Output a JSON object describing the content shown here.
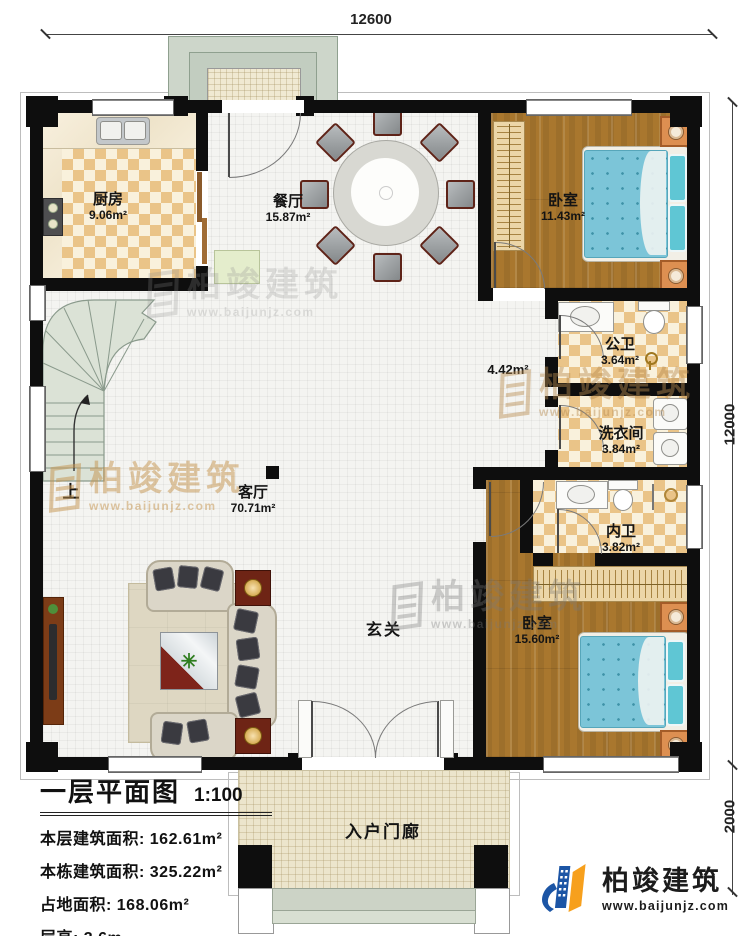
{
  "plan": {
    "dimensions": {
      "top_width": "12600",
      "right_height": "12000",
      "right_porch": "2000"
    },
    "rooms": {
      "kitchen": {
        "name": "厨房",
        "area": "9.06m²"
      },
      "dining": {
        "name": "餐厅",
        "area": "15.87m²"
      },
      "bedroom_top": {
        "name": "卧室",
        "area": "11.43m²"
      },
      "public_bath": {
        "name": "公卫",
        "area": "3.64m²"
      },
      "laundry": {
        "name": "洗衣间",
        "area": "3.84m²"
      },
      "inner_bath": {
        "name": "内卫",
        "area": "3.82m²"
      },
      "bedroom_bottom": {
        "name": "卧室",
        "area": "15.60m²"
      },
      "living": {
        "name": "客厅",
        "area": "70.71m²"
      },
      "hall_area": "4.42m²",
      "foyer": "玄关",
      "entry_porch": "入户门廊",
      "stairs_up": "上"
    }
  },
  "title_block": {
    "title": "一层平面图",
    "scale": "1:100",
    "info_lines": [
      "本层建筑面积: 162.61m²",
      "本栋建筑面积: 325.22m²",
      "占地面积: 168.06m²",
      "层高: 3.6m"
    ]
  },
  "branding": {
    "company": "柏竣建筑",
    "website": "www.baijunjz.com"
  },
  "watermark": {
    "company": "柏竣建筑",
    "website": "www.baijunjz.com"
  },
  "colors": {
    "wall": "#0e0e0e",
    "wood_floor": "#a9772e",
    "tile": "#eac488",
    "mattress": "#7cc5d8",
    "stairs": "#dbe2d6",
    "logo_blue": "#1c55a5",
    "logo_orange": "#f7a01d"
  }
}
